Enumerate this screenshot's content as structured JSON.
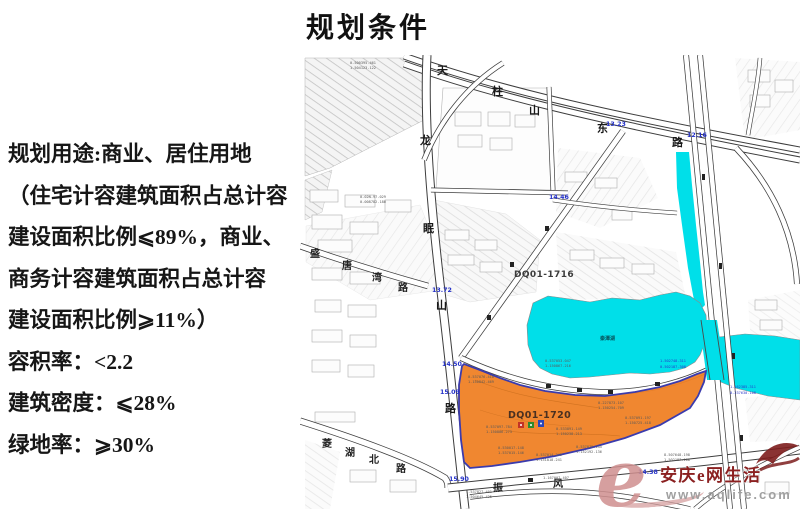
{
  "page_title": "规划条件",
  "left_panel": {
    "lines": [
      "规划用途:商业、居住用地",
      "（住宅计容建筑面积占总计容",
      "建设面积比例⩽89%，商业、",
      "商务计容建筑面积占总计容",
      "建设面积比例⩾11%）",
      "容积率：<2.2",
      "建筑密度：⩽28%",
      "绿地率：⩾30%"
    ]
  },
  "map": {
    "roads": {
      "tianzhushan": "天柱山东路",
      "longmianshan": "龙眠山路",
      "shengtangwan": "盛唐湾路",
      "linghubei": "菱湖北路",
      "zhenfeng": "振风"
    },
    "parcel_labels": [
      "DQ01-1716",
      "DQ01-1720"
    ],
    "lake_label": "秦潭湖",
    "elevations": [
      "13.23",
      "12.16",
      "14.46",
      "13.72",
      "14.50",
      "15.09",
      "15.90",
      "14.38"
    ],
    "survey": [
      "0-500395.461",
      "1-504123.122",
      "0-02N-97.029",
      "0-008782.180",
      "0-537053.047",
      "1-150867.216",
      "0-537076.410",
      "1-150842.469",
      "0-537097.784",
      "1-150806.273",
      "0-533891.149",
      "1-150238.213",
      "0-227873.107",
      "1-150254.709",
      "0-537091.197",
      "1-150725.418",
      "0-537875.145",
      "1-152192.136",
      "0-537014.245",
      "1-151818.241",
      "0-530017.148",
      "1-537015.146",
      "1-167007.407",
      "1-537827.401",
      "1-504645.425",
      "8-507648.198",
      "1-502187.108"
    ],
    "water_labels": [
      "1-502748.311",
      "0-502187.308",
      "1-162385.311",
      "0-237630.108"
    ],
    "colors": {
      "water": "#00dfe9",
      "parcel_fill": "#ef8125",
      "parcel_border": "#3b3bad",
      "elevation_text": "#2431c8"
    }
  },
  "watermark": {
    "e": "e",
    "site": "安庆e网生活",
    "url": "www.aqlife.com"
  }
}
